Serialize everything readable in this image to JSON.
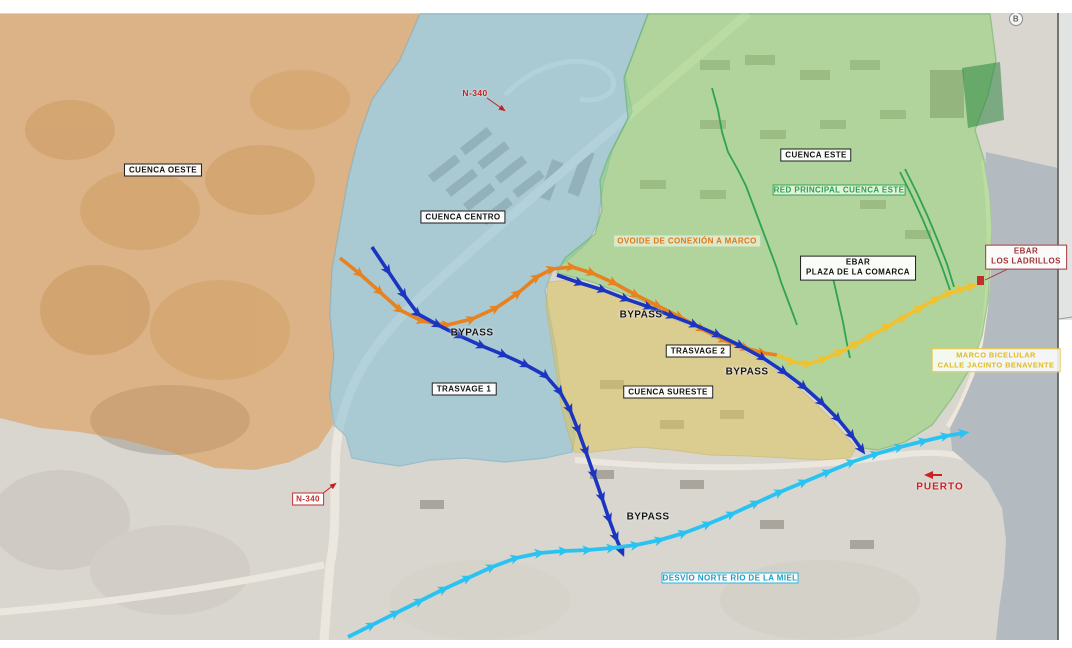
{
  "page": {
    "marker_b": "B"
  },
  "zones": {
    "oeste": {
      "label": "CUENCA OESTE",
      "color": "#dd8f3f"
    },
    "centro": {
      "label": "CUENCA CENTRO",
      "color": "#7bbdd8"
    },
    "este": {
      "label": "CUENCA ESTE",
      "color": "#8ed36f"
    },
    "sureste": {
      "label": "CUENCA SURESTE",
      "color": "#ddc45d"
    }
  },
  "routes": {
    "ovoide": {
      "label": "OVOIDE DE CONEXIÓN A MARCO",
      "color": "#e8821e"
    },
    "bypass": {
      "label": "BYPASS",
      "color": "#1b35c0"
    },
    "trasvage1": {
      "label": "TRASVAGE 1",
      "color": "#1b35c0"
    },
    "trasvage2": {
      "label": "TRASVAGE 2",
      "color": "#1b35c0"
    },
    "desvio": {
      "label": "DESVÍO NORTE RÍO DE LA MIEL",
      "color": "#29c3f2"
    },
    "marco": {
      "line1": "MARCO BICELULAR",
      "line2": "CALLE JACINTO BENAVENTE",
      "color": "#f2c12e"
    },
    "red_principal": {
      "label": "RED PRINCIPAL CUENCA ESTE",
      "color": "#2fa352"
    }
  },
  "stations": {
    "ebar_comarca": {
      "line1": "EBAR",
      "line2": "PLAZA DE LA COMARCA"
    },
    "ebar_ladrillos": {
      "line1": "EBAR",
      "line2": "LOS LADRILLOS"
    }
  },
  "places": {
    "puerto": "PUERTO",
    "road_n340": "N-340"
  },
  "base_colors": {
    "land": "#d9d6cf",
    "water": "#b3bac0",
    "road": "#ece7de",
    "marker_red": "#c42222"
  }
}
